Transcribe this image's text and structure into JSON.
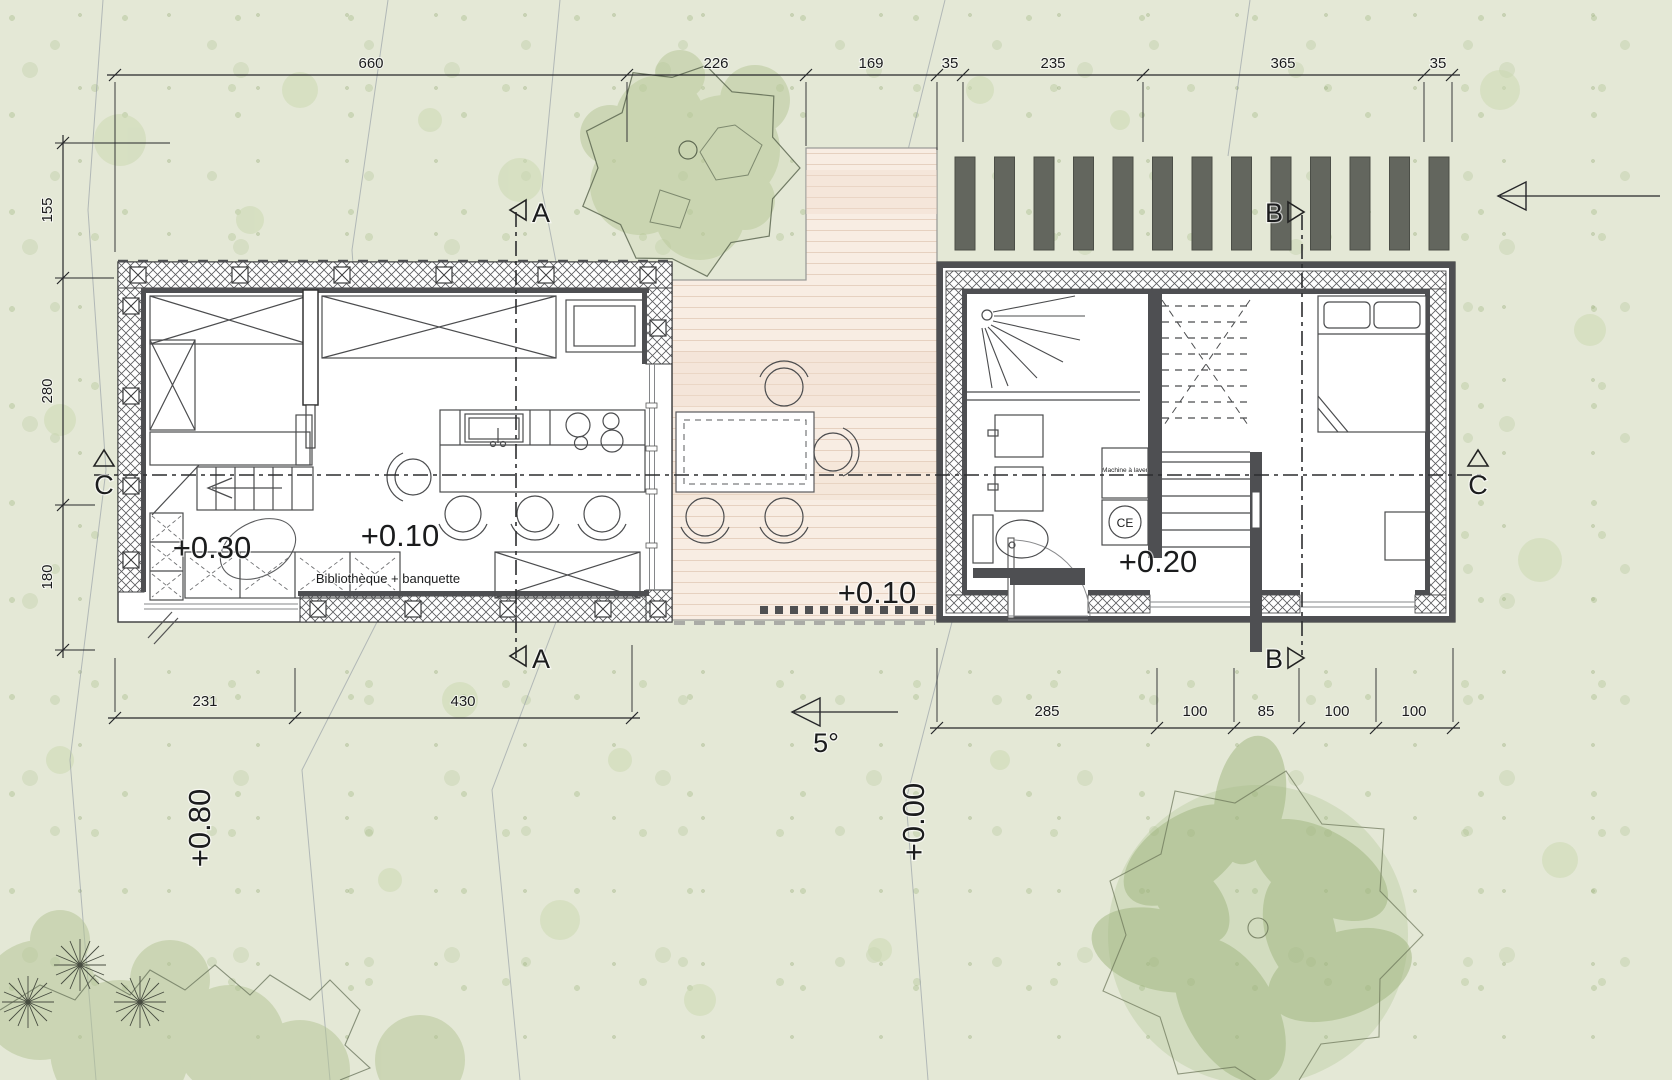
{
  "plan": {
    "levels": {
      "entry": "+0.30",
      "living": "+0.10",
      "terrace": "+0.10",
      "night": "+0.20",
      "terrain_left": "+0.80",
      "terrain_right": "+0.00"
    },
    "slope_angle": "5°",
    "section_markers": {
      "a": "A",
      "b": "B",
      "c": "C"
    },
    "notes": {
      "library": "Bibliothèque + banquette",
      "washer": "Machine à laver",
      "heater": "CE"
    },
    "dims": {
      "top": [
        "660",
        "226",
        "169",
        "35",
        "235",
        "365",
        "35"
      ],
      "left": [
        "155",
        "280",
        "180"
      ],
      "bottom_left": [
        "231",
        "430"
      ],
      "bottom_right": [
        "285",
        "100",
        "85",
        "100",
        "100"
      ]
    },
    "colors": {
      "ground": "#e4e8d6",
      "deck": "#f8ede3",
      "wall": "#4e4f52",
      "louver": "#63665e",
      "tree": "#a9bd8d"
    }
  }
}
